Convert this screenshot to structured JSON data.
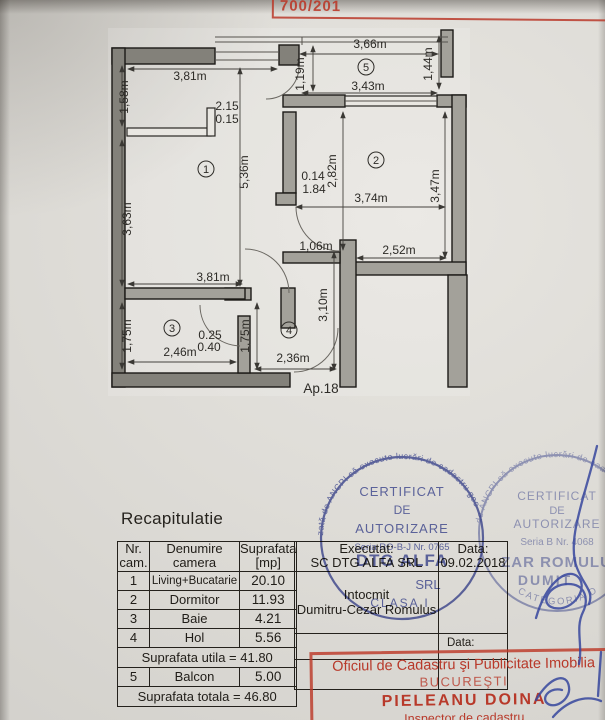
{
  "stamp_top": {
    "number": "700/201"
  },
  "plan": {
    "apartment_label": "Ap.18",
    "room_numbers": {
      "living": "1",
      "dormitor": "2",
      "baie": "3",
      "hol": "4",
      "balcon": "5"
    },
    "dims": {
      "balcony_width_top": "3,66m",
      "balcony_width_bottom": "3,43m",
      "balcony_height_right": "1,44m",
      "balcony_height_left": "1,19m",
      "entry_width_top": "3,81m",
      "entry_height_left": "1,58m",
      "entry_note_a": "2.15",
      "entry_note_b": "0.15",
      "living_height_right": "5,36m",
      "living_height_left": "3,63m",
      "living_width_bottom": "3,81m",
      "step_note_a": "0.14",
      "step_note_b": "1.84",
      "dormitor_height_left": "2,82m",
      "dormitor_width": "3,74m",
      "dormitor_height_right": "3,47m",
      "niche_width": "1,06m",
      "dormitor_width_bottom": "2,52m",
      "hol_height_right": "3,10m",
      "hol_height_mid": "1,75m",
      "hol_width_bottom": "2,36m",
      "baie_note_a": "0.25",
      "baie_note_b": "0.40",
      "baie_width": "2,46m",
      "baie_height_left": "1,75m"
    }
  },
  "recap": {
    "title": "Recapitulatie",
    "headers": {
      "nr_line1": "Nr.",
      "nr_line2": "cam.",
      "den_line1": "Denumire",
      "den_line2": "camera",
      "sup_line1": "Suprafata",
      "sup_line2": "[mp]"
    },
    "rows": [
      {
        "nr": "1",
        "name": "Living+Bucatarie",
        "area": "20.10"
      },
      {
        "nr": "2",
        "name": "Dormitor",
        "area": "11.93"
      },
      {
        "nr": "3",
        "name": "Baie",
        "area": "4.21"
      },
      {
        "nr": "4",
        "name": "Hol",
        "area": "5.56"
      }
    ],
    "subtotal": "Suprafata utila = 41.80",
    "balcony_row": {
      "nr": "5",
      "name": "Balcon",
      "area": "5.00"
    },
    "total": "Suprafata totala = 46.80"
  },
  "exec": {
    "executat_label": "Executat:",
    "company": "SC DTG ALFA SRL",
    "data_label": "Data:",
    "date": "09.02.2018",
    "intocmit_label": "Intocmit",
    "name": "Dumitru-Cezar Romulus",
    "data_label_2": "Data:"
  },
  "stamps": {
    "left": {
      "ring": "zată de ANCPI să execute lucrări de cadastru geo",
      "title1": "CERTIFICAT",
      "title2": "DE",
      "title3": "AUTORIZARE",
      "serial": "Seria RO-B-J Nr. 0765",
      "company": "DTG ALFA",
      "company_suffix": "SRL",
      "clasa": "CLASA I"
    },
    "right": {
      "ring": "de ANCPI să execute lucrări de cad",
      "ring_bottom": "CATEGORIA D",
      "title1": "CERTIFICAT",
      "title2": "DE",
      "title3": "AUTORIZARE",
      "serial": "Seria B  Nr. 4068",
      "name1": "ZAR ROMULUS",
      "name2": "DUMIT"
    },
    "oficiu": {
      "line1": "Oficiul de Cadastru şi Publicitate Imobilia",
      "line2": "BUCUREŞTI",
      "line3": "PIELEANU DOINA",
      "line4": "Inspector de cadastru"
    }
  }
}
